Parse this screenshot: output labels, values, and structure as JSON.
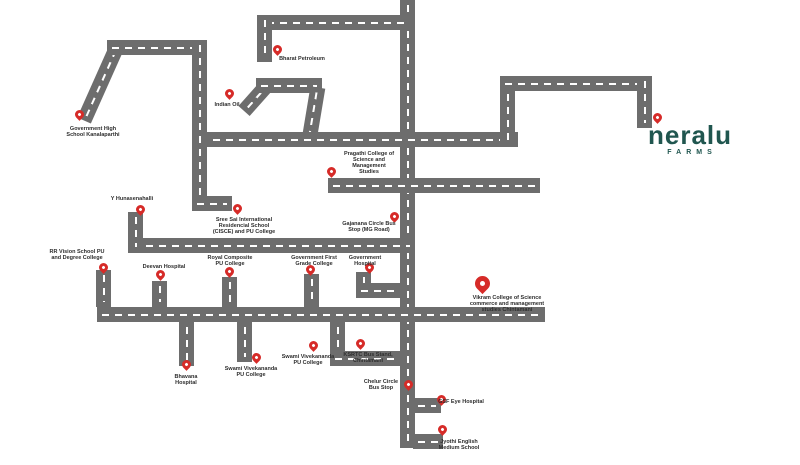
{
  "canvas": {
    "width": 800,
    "height": 465,
    "background": "#ffffff"
  },
  "colors": {
    "road": "#6d6d6d",
    "dash": "#ffffff",
    "pin": "#d62b28",
    "label": "#2e2e2e",
    "logo": "#20564f"
  },
  "logo": {
    "wordmark": "neralu",
    "tagline": "FARMS"
  },
  "map": {
    "roads": [
      {
        "id": "main-vertical",
        "type": "v",
        "x": 400,
        "y": 0,
        "len": 448
      },
      {
        "id": "top-horizontal",
        "type": "h",
        "x": 262,
        "y": 15,
        "len": 153
      },
      {
        "id": "bharat-petroleum-spur",
        "type": "v",
        "x": 257,
        "y": 15,
        "len": 47
      },
      {
        "id": "indian-oil-diagonal-left",
        "type": "d",
        "x1": 244,
        "y1": 111,
        "x2": 268,
        "y2": 84
      },
      {
        "id": "indian-oil-horizontal",
        "type": "h",
        "x": 256,
        "y": 78,
        "len": 66
      },
      {
        "id": "indian-oil-diagonal-right",
        "type": "d",
        "x1": 318,
        "y1": 87,
        "x2": 309,
        "y2": 141
      },
      {
        "id": "main-horizontal-north",
        "type": "h",
        "x": 195,
        "y": 132,
        "len": 323
      },
      {
        "id": "northeast-vertical-left",
        "type": "v",
        "x": 500,
        "y": 76,
        "len": 71
      },
      {
        "id": "northeast-horizontal",
        "type": "h",
        "x": 500,
        "y": 76,
        "len": 152
      },
      {
        "id": "neralu-spur",
        "type": "v",
        "x": 637,
        "y": 76,
        "len": 52
      },
      {
        "id": "northwest-diagonal",
        "type": "d",
        "x1": 84,
        "y1": 120,
        "x2": 117,
        "y2": 46
      },
      {
        "id": "northwest-horizontal",
        "type": "h",
        "x": 107,
        "y": 40,
        "len": 100
      },
      {
        "id": "west-vertical",
        "type": "v",
        "x": 192,
        "y": 40,
        "len": 171
      },
      {
        "id": "sree-sai-foot",
        "type": "h",
        "x": 192,
        "y": 196,
        "len": 40
      },
      {
        "id": "mg-road-horizontal",
        "type": "h",
        "x": 128,
        "y": 238,
        "len": 287
      },
      {
        "id": "hunasenahalli-spur",
        "type": "v",
        "x": 128,
        "y": 212,
        "len": 40
      },
      {
        "id": "main-horizontal-south",
        "type": "h",
        "x": 97,
        "y": 307,
        "len": 448
      },
      {
        "id": "rr-vision-spur",
        "type": "v",
        "x": 96,
        "y": 270,
        "len": 37
      },
      {
        "id": "deevan-spur",
        "type": "v",
        "x": 152,
        "y": 281,
        "len": 26
      },
      {
        "id": "royal-composite-spur",
        "type": "v",
        "x": 222,
        "y": 277,
        "len": 30
      },
      {
        "id": "govt-first-grade-spur",
        "type": "v",
        "x": 304,
        "y": 274,
        "len": 33
      },
      {
        "id": "govt-hospital-spur",
        "type": "v",
        "x": 356,
        "y": 272,
        "len": 24
      },
      {
        "id": "govt-hospital-link",
        "type": "h",
        "x": 356,
        "y": 283,
        "len": 46
      },
      {
        "id": "bhavana-spur",
        "type": "v",
        "x": 179,
        "y": 322,
        "len": 44
      },
      {
        "id": "swami-vivekananda-spur",
        "type": "v",
        "x": 237,
        "y": 322,
        "len": 40
      },
      {
        "id": "ksrtc-spur",
        "type": "v",
        "x": 330,
        "y": 322,
        "len": 44
      },
      {
        "id": "ksrtc-link",
        "type": "h",
        "x": 330,
        "y": 351,
        "len": 72
      },
      {
        "id": "gsf-eye-spur",
        "type": "h",
        "x": 413,
        "y": 398,
        "len": 28
      },
      {
        "id": "jyothi-spur",
        "type": "h",
        "x": 413,
        "y": 434,
        "len": 30
      },
      {
        "id": "pragathi-horizontal",
        "type": "h",
        "x": 328,
        "y": 178,
        "len": 212
      }
    ],
    "pins": [
      {
        "id": "government-high-school",
        "tip": [
          79,
          121
        ],
        "size": "s",
        "label": {
          "lines": [
            "Government High",
            "School Kanalaparthi"
          ],
          "cx": 93,
          "top": 126
        }
      },
      {
        "id": "bharat-petroleum",
        "tip": [
          277,
          56
        ],
        "size": "s",
        "label": {
          "lines": [
            "Bharat Petroleum"
          ],
          "cx": 302,
          "top": 56
        }
      },
      {
        "id": "indian-oil",
        "tip": [
          229,
          100
        ],
        "size": "s",
        "label": {
          "lines": [
            "Indian Oil"
          ],
          "cx": 227,
          "top": 102
        }
      },
      {
        "id": "pragathi-college",
        "tip": [
          331,
          178
        ],
        "size": "s",
        "label": {
          "lines": [
            "Pragathi College of",
            "Science and",
            "Management",
            "Studies"
          ],
          "cx": 369,
          "top": 151
        }
      },
      {
        "id": "y-hunasenahalli",
        "tip": [
          140,
          216
        ],
        "size": "s",
        "label": {
          "lines": [
            "Y Hunasenahalli"
          ],
          "cx": 132,
          "top": 196
        }
      },
      {
        "id": "sree-sai-school",
        "tip": [
          237,
          215
        ],
        "size": "s",
        "label": {
          "lines": [
            "Sree Sai International",
            "Residencial School",
            "(CISCE) and PU College"
          ],
          "cx": 244,
          "top": 217
        }
      },
      {
        "id": "gajanana-circle-bus-stop",
        "tip": [
          394,
          223
        ],
        "size": "s",
        "label": {
          "lines": [
            "Gajanana Circle Bus",
            "Stop (MG Road)"
          ],
          "cx": 369,
          "top": 221
        }
      },
      {
        "id": "rr-vision-school",
        "tip": [
          103,
          274
        ],
        "size": "s",
        "label": {
          "lines": [
            "RR Vision School PU",
            "and Degree College"
          ],
          "cx": 77,
          "top": 249
        }
      },
      {
        "id": "deevan-hospital",
        "tip": [
          160,
          281
        ],
        "size": "s",
        "label": {
          "lines": [
            "Deevan Hospital"
          ],
          "cx": 164,
          "top": 264
        }
      },
      {
        "id": "royal-composite-college",
        "tip": [
          229,
          278
        ],
        "size": "s",
        "label": {
          "lines": [
            "Royal Composite",
            "PU College"
          ],
          "cx": 230,
          "top": 255
        }
      },
      {
        "id": "government-first-grade-college",
        "tip": [
          310,
          276
        ],
        "size": "s",
        "label": {
          "lines": [
            "Government First",
            "Grade College"
          ],
          "cx": 314,
          "top": 255
        }
      },
      {
        "id": "government-hospital",
        "tip": [
          369,
          274
        ],
        "size": "s",
        "label": {
          "lines": [
            "Government",
            "Hospital"
          ],
          "cx": 365,
          "top": 255
        }
      },
      {
        "id": "vikram-college",
        "tip": [
          482,
          294
        ],
        "size": "l",
        "label": {
          "lines": [
            "Vikram College of Science",
            "commerce and management",
            "studies Chintamani"
          ],
          "cx": 507,
          "top": 295
        }
      },
      {
        "id": "bhavana-hospital",
        "tip": [
          186,
          371
        ],
        "size": "s",
        "label": {
          "lines": [
            "Bhavana",
            "Hospital"
          ],
          "cx": 186,
          "top": 374
        }
      },
      {
        "id": "swami-vivekananda-pu-college-west",
        "tip": [
          256,
          364
        ],
        "size": "s",
        "label": {
          "lines": [
            "Swami Vivekananda",
            "PU College"
          ],
          "cx": 251,
          "top": 366
        }
      },
      {
        "id": "swami-vivekananda-pu-college-east",
        "tip": [
          313,
          352
        ],
        "size": "s",
        "label": {
          "lines": [
            "Swami Vivekananda",
            "PU College"
          ],
          "cx": 308,
          "top": 354
        }
      },
      {
        "id": "ksrtc-bus-stand",
        "tip": [
          360,
          350
        ],
        "size": "s",
        "label": {
          "lines": [
            "KSRTC Bus Stand,",
            "Chintamani"
          ],
          "cx": 368,
          "top": 352
        }
      },
      {
        "id": "chelur-circle-bus-stop",
        "tip": [
          408,
          391
        ],
        "size": "s",
        "label": {
          "lines": [
            "Chelur Circle",
            "Bus Stop"
          ],
          "cx": 381,
          "top": 379
        }
      },
      {
        "id": "gsf-eye-hospital",
        "tip": [
          441,
          406
        ],
        "size": "s",
        "label": {
          "lines": [
            "GSF Eye Hospital"
          ],
          "cx": 461,
          "top": 399
        }
      },
      {
        "id": "jyothi-english-school",
        "tip": [
          442,
          436
        ],
        "size": "s",
        "label": {
          "lines": [
            "Jyothi English",
            "Medium School"
          ],
          "cx": 459,
          "top": 439
        }
      },
      {
        "id": "neralu-farms-location",
        "tip": [
          657,
          124
        ],
        "size": "s",
        "label": null
      }
    ]
  }
}
